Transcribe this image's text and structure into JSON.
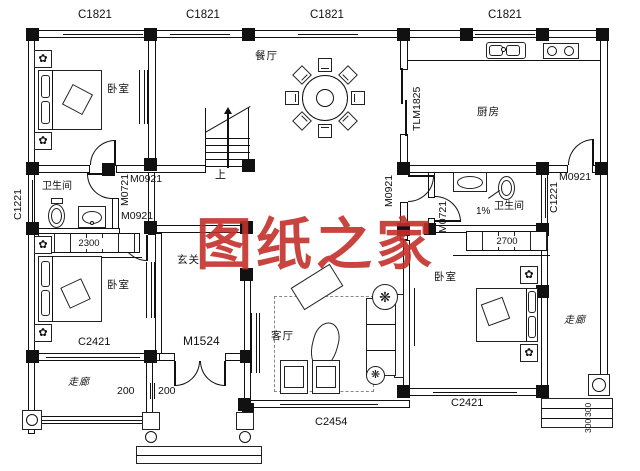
{
  "watermark": {
    "text": "图纸之家",
    "color": "#c5302b"
  },
  "rooms": {
    "bedroom": "卧室",
    "dining": "餐厅",
    "kitchen": "厨房",
    "bathroom": "卫生间",
    "hall": "玄关",
    "living": "客厅",
    "corridor": "走廊"
  },
  "openings": {
    "c1821": "C1821",
    "c1221": "C1221",
    "c2421": "C2421",
    "c2454": "C2454",
    "m0921": "M0921",
    "m0721": "M0721",
    "m1524": "M1524",
    "tlm1825": "TLM1825"
  },
  "dimensions": {
    "closet_left": "2300",
    "closet_right": "2700",
    "porch_left": "200",
    "porch_right": "200",
    "side_step": "300",
    "slope": "1%"
  },
  "annotations": {
    "stairs_up": "上"
  },
  "icons": {
    "flower": "✿",
    "plant": "❋"
  },
  "colors": {
    "line": "#111111",
    "watermark": "#c5302b",
    "paper": "#ffffff"
  }
}
